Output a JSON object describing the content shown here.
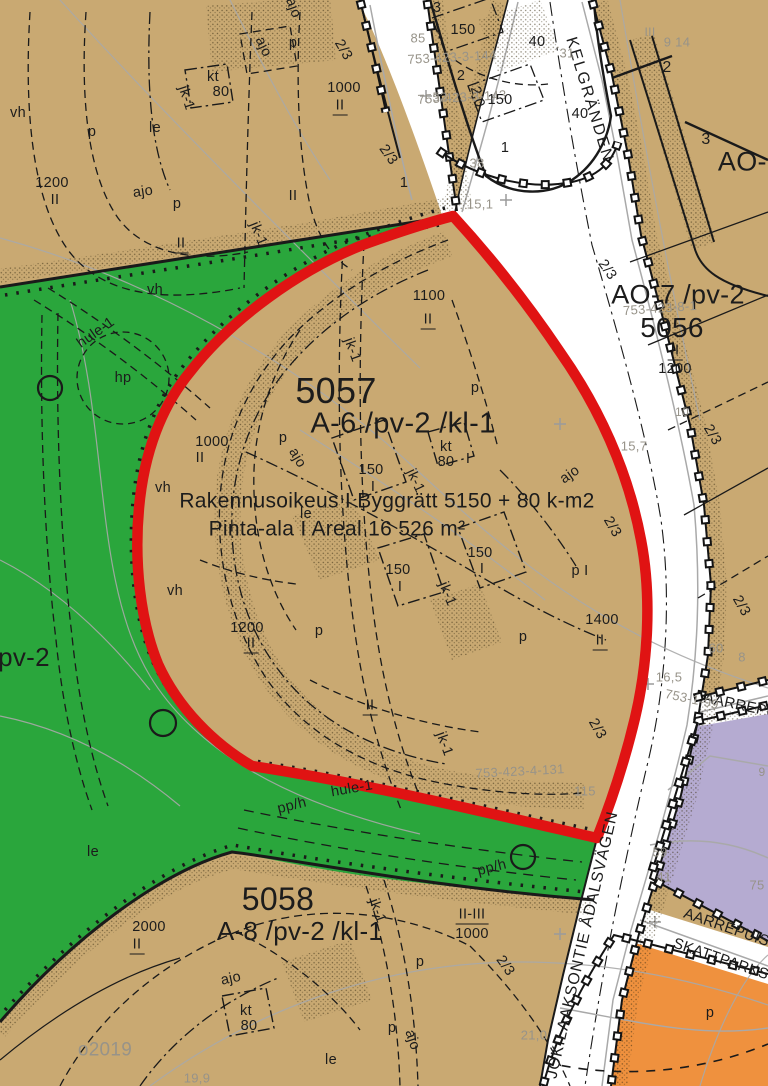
{
  "map": {
    "colors": {
      "block_tan": "#c9a972",
      "park_green": "#2aa63c",
      "plan_boundary_red": "#e01313",
      "public_building_purple": "#b5abd1",
      "commercial_orange": "#ef913e",
      "road_white": "#ffffff",
      "faint_text_gray": "#979389",
      "line_black": "#1a1a1a"
    },
    "main_area": {
      "block_number": "5057",
      "designation": "A-6  /pv-2    /kl-1",
      "building_right": "Rakennusoikeus I Byggrätt 5150 + 80 k-m2",
      "area_text": "Pinta-ala I Areal 16 526 m²"
    },
    "streets": [
      "KELGRÄNDEN",
      "JOKILAAKSONTIE ÅDALSVÄGEN",
      "AARREPUIST",
      "SKATTPARKS"
    ],
    "labels": [
      {
        "t": "5057",
        "x": 336,
        "y": 391,
        "fs": 36
      },
      {
        "t": "A-6   /pv-2    /kl-1",
        "x": 403,
        "y": 424,
        "fs": 29
      },
      {
        "t": "Rakennusoikeus I Byggrätt 5150 + 80 k-m2",
        "x": 387,
        "y": 501,
        "fs": 21
      },
      {
        "t": "Pinta-ala I Areal 16 526 m²",
        "x": 337,
        "y": 529,
        "fs": 21
      },
      {
        "t": "AO-7 /pv-2",
        "x": 678,
        "y": 295,
        "fs": 27
      },
      {
        "t": "5056",
        "x": 672,
        "y": 328,
        "fs": 28
      },
      {
        "t": "5058",
        "x": 278,
        "y": 899,
        "fs": 32
      },
      {
        "t": "A-8   /pv-2    /kl-1",
        "x": 300,
        "y": 931,
        "fs": 26
      },
      {
        "t": "AO-1",
        "x": 750,
        "y": 162,
        "fs": 27
      },
      {
        "t": "pv-2",
        "x": 24,
        "y": 657,
        "fs": 26
      },
      {
        "t": "KELGRÄNDEN",
        "x": 589,
        "y": 100,
        "fs": 16,
        "r": 73,
        "ls": 2,
        "n": "street-name"
      },
      {
        "t": "JOKILAAKSONTIE ÅDALSVÄGEN",
        "x": 583,
        "y": 945,
        "fs": 16,
        "r": -77,
        "ls": 1,
        "n": "street-name"
      },
      {
        "t": "AARREPUIS",
        "x": 748,
        "y": 707,
        "fs": 15,
        "r": 12,
        "n": "street-name"
      },
      {
        "t": "AARREPUIST",
        "x": 731,
        "y": 929,
        "fs": 15,
        "r": 19,
        "n": "street-name"
      },
      {
        "t": "SKATTPARKS",
        "x": 721,
        "y": 959,
        "fs": 15,
        "r": 19,
        "n": "street-name"
      },
      {
        "t": "753-1-99",
        "x": 692,
        "y": 699,
        "cl": "gry",
        "fs": 13,
        "r": 12
      },
      {
        "t": "753-423-4-131",
        "x": 520,
        "y": 771,
        "cl": "gry",
        "fs": 13,
        "r": -3
      },
      {
        "t": "753-423-8-1",
        "x": 660,
        "y": 308,
        "cl": "gry",
        "fs": 13,
        "r": -4
      },
      {
        "t": "753-423-3-144",
        "x": 452,
        "y": 57,
        "cl": "gry",
        "fs": 13,
        "r": -3
      },
      {
        "t": "753-423-3-143",
        "x": 462,
        "y": 97,
        "cl": "gry",
        "fs": 13,
        "r": -3
      },
      {
        "t": "15,1",
        "x": 480,
        "y": 204,
        "cl": "gry",
        "fs": 13
      },
      {
        "t": "15,7",
        "x": 634,
        "y": 446,
        "cl": "gry",
        "fs": 13
      },
      {
        "t": "16,5",
        "x": 669,
        "y": 677,
        "cl": "gry",
        "fs": 13
      },
      {
        "t": "21,0",
        "x": 534,
        "y": 1035,
        "cl": "gry",
        "fs": 13
      },
      {
        "t": "19,9",
        "x": 197,
        "y": 1078,
        "cl": "gry",
        "fs": 13
      },
      {
        "t": "85",
        "x": 418,
        "y": 38,
        "cl": "gry",
        "fs": 13
      },
      {
        "t": "52",
        "x": 440,
        "y": 97,
        "cl": "gry",
        "fs": 13
      },
      {
        "t": "38",
        "x": 477,
        "y": 163,
        "cl": "gry",
        "fs": 13
      },
      {
        "t": "31",
        "x": 567,
        "y": 53,
        "cl": "gry",
        "fs": 13
      },
      {
        "t": "9 14",
        "x": 677,
        "y": 42,
        "cl": "gry",
        "fs": 13
      },
      {
        "t": "III",
        "x": 650,
        "y": 32,
        "cl": "gry",
        "fs": 12
      },
      {
        "t": "o2019",
        "x": 105,
        "y": 1050,
        "cl": "gry",
        "fs": 19
      },
      {
        "t": "59",
        "x": 660,
        "y": 852,
        "cl": "gry",
        "fs": 13
      },
      {
        "t": "41",
        "x": 664,
        "y": 877,
        "cl": "gry",
        "fs": 13
      },
      {
        "t": "75",
        "x": 757,
        "y": 885,
        "cl": "gry",
        "fs": 13
      },
      {
        "t": "115",
        "x": 585,
        "y": 791,
        "cl": "gry",
        "fs": 13
      },
      {
        "t": "8",
        "x": 742,
        "y": 657,
        "cl": "gry",
        "fs": 13
      },
      {
        "t": "60",
        "x": 716,
        "y": 648,
        "cl": "gry",
        "fs": 13
      },
      {
        "t": "10",
        "x": 682,
        "y": 412,
        "cl": "gry",
        "fs": 12
      },
      {
        "t": "9",
        "x": 762,
        "y": 772,
        "cl": "gry",
        "fs": 12
      },
      {
        "t": "1200",
        "x": 52,
        "y": 183
      },
      {
        "t": "II",
        "x": 55,
        "y": 200
      },
      {
        "t": "1000",
        "x": 344,
        "y": 88
      },
      {
        "t": "II",
        "x": 340,
        "y": 107,
        "u": 1
      },
      {
        "t": "1100",
        "x": 429,
        "y": 296
      },
      {
        "t": "II",
        "x": 428,
        "y": 321,
        "u": 1
      },
      {
        "t": "1000",
        "x": 212,
        "y": 442
      },
      {
        "t": "II",
        "x": 200,
        "y": 458
      },
      {
        "t": "1200",
        "x": 247,
        "y": 628
      },
      {
        "t": "II",
        "x": 251,
        "y": 645,
        "u": 1
      },
      {
        "t": "1400",
        "x": 602,
        "y": 620
      },
      {
        "t": "II",
        "x": 600,
        "y": 642,
        "u": 1
      },
      {
        "t": "II",
        "x": 675,
        "y": 352,
        "u": 1
      },
      {
        "t": "1200",
        "x": 675,
        "y": 369
      },
      {
        "t": "2000",
        "x": 149,
        "y": 927
      },
      {
        "t": "II",
        "x": 137,
        "y": 946,
        "u": 1
      },
      {
        "t": "II-III",
        "x": 472,
        "y": 916,
        "u": 1
      },
      {
        "t": "1000",
        "x": 472,
        "y": 934
      },
      {
        "t": "II",
        "x": 293,
        "y": 196
      },
      {
        "t": "II",
        "x": 181,
        "y": 245,
        "u": 1
      },
      {
        "t": "II",
        "x": 370,
        "y": 707,
        "u": 1
      },
      {
        "t": "150",
        "x": 463,
        "y": 30
      },
      {
        "t": "40",
        "x": 537,
        "y": 42
      },
      {
        "t": "150",
        "x": 500,
        "y": 100
      },
      {
        "t": "40",
        "x": 580,
        "y": 114
      },
      {
        "t": "150",
        "x": 371,
        "y": 470
      },
      {
        "t": "I",
        "x": 373,
        "y": 487
      },
      {
        "t": "150",
        "x": 480,
        "y": 553
      },
      {
        "t": "I",
        "x": 482,
        "y": 569
      },
      {
        "t": "150",
        "x": 398,
        "y": 570
      },
      {
        "t": "I",
        "x": 400,
        "y": 587
      },
      {
        "t": "kt",
        "x": 446,
        "y": 447
      },
      {
        "t": "80",
        "x": 446,
        "y": 462
      },
      {
        "t": "I",
        "x": 468,
        "y": 459
      },
      {
        "t": "kt",
        "x": 213,
        "y": 77
      },
      {
        "t": "80",
        "x": 221,
        "y": 92
      },
      {
        "t": "kt",
        "x": 246,
        "y": 1011
      },
      {
        "t": "80",
        "x": 249,
        "y": 1026
      },
      {
        "t": "2",
        "x": 667,
        "y": 68,
        "fs": 16
      },
      {
        "t": "3",
        "x": 706,
        "y": 140,
        "fs": 16
      },
      {
        "t": "2",
        "x": 461,
        "y": 76
      },
      {
        "t": "3",
        "x": 437,
        "y": 8
      },
      {
        "t": "1",
        "x": 505,
        "y": 148
      },
      {
        "t": "1",
        "x": 404,
        "y": 183
      },
      {
        "t": "p",
        "x": 92,
        "y": 132
      },
      {
        "t": "le",
        "x": 155,
        "y": 128
      },
      {
        "t": "ajo",
        "x": 143,
        "y": 192,
        "r": -8
      },
      {
        "t": "p",
        "x": 177,
        "y": 204
      },
      {
        "t": "p",
        "x": 293,
        "y": 43
      },
      {
        "t": "ajo",
        "x": 263,
        "y": 47,
        "r": 65
      },
      {
        "t": "ajo",
        "x": 293,
        "y": 8,
        "r": 70
      },
      {
        "t": "vh",
        "x": 18,
        "y": 113
      },
      {
        "t": "vh",
        "x": 155,
        "y": 290
      },
      {
        "t": "vh",
        "x": 163,
        "y": 488
      },
      {
        "t": "vh",
        "x": 175,
        "y": 591
      },
      {
        "t": "hp",
        "x": 123,
        "y": 378
      },
      {
        "t": "hule-1",
        "x": 96,
        "y": 333,
        "r": -35
      },
      {
        "t": "hule-1",
        "x": 352,
        "y": 789,
        "r": -10
      },
      {
        "t": "pp/h",
        "x": 292,
        "y": 806,
        "r": -14
      },
      {
        "t": "pp/h",
        "x": 492,
        "y": 868,
        "r": -14
      },
      {
        "t": "p",
        "x": 283,
        "y": 438
      },
      {
        "t": "ajo",
        "x": 297,
        "y": 458,
        "r": 60
      },
      {
        "t": "p",
        "x": 475,
        "y": 388
      },
      {
        "t": "ajo",
        "x": 570,
        "y": 475,
        "r": -35
      },
      {
        "t": "p",
        "x": 319,
        "y": 631
      },
      {
        "t": "p",
        "x": 523,
        "y": 637
      },
      {
        "t": "p  I",
        "x": 580,
        "y": 571
      },
      {
        "t": "le",
        "x": 306,
        "y": 514
      },
      {
        "t": "le",
        "x": 93,
        "y": 852
      },
      {
        "t": "le",
        "x": 331,
        "y": 1060
      },
      {
        "t": "p",
        "x": 420,
        "y": 962
      },
      {
        "t": "ajo",
        "x": 231,
        "y": 979,
        "r": -12
      },
      {
        "t": "p",
        "x": 392,
        "y": 1028
      },
      {
        "t": "ajo",
        "x": 412,
        "y": 1040,
        "r": 72
      },
      {
        "t": "p",
        "x": 710,
        "y": 1013
      },
      {
        "t": "jk-1",
        "x": 186,
        "y": 98,
        "r": 72
      },
      {
        "t": "jk-1",
        "x": 258,
        "y": 234,
        "r": 68
      },
      {
        "t": "jk-1",
        "x": 352,
        "y": 350,
        "r": 70
      },
      {
        "t": "jk-1",
        "x": 415,
        "y": 481,
        "r": 65
      },
      {
        "t": "jk-1",
        "x": 447,
        "y": 594,
        "r": 68
      },
      {
        "t": "jk-1",
        "x": 444,
        "y": 744,
        "r": 70
      },
      {
        "t": "jk-1",
        "x": 377,
        "y": 911,
        "r": 70
      },
      {
        "t": "2/3",
        "x": 343,
        "y": 50,
        "r": 60
      },
      {
        "t": "2/3",
        "x": 388,
        "y": 155,
        "r": 55
      },
      {
        "t": "2/3",
        "x": 607,
        "y": 270,
        "r": 55
      },
      {
        "t": "2/3",
        "x": 712,
        "y": 435,
        "r": 60
      },
      {
        "t": "2/3",
        "x": 612,
        "y": 527,
        "r": 60
      },
      {
        "t": "2/3",
        "x": 741,
        "y": 606,
        "r": 60
      },
      {
        "t": "2/3",
        "x": 597,
        "y": 729,
        "r": 60
      },
      {
        "t": "2/3",
        "x": 505,
        "y": 966,
        "r": 55
      },
      {
        "t": "2,0",
        "x": 477,
        "y": 97,
        "r": 75
      }
    ]
  }
}
